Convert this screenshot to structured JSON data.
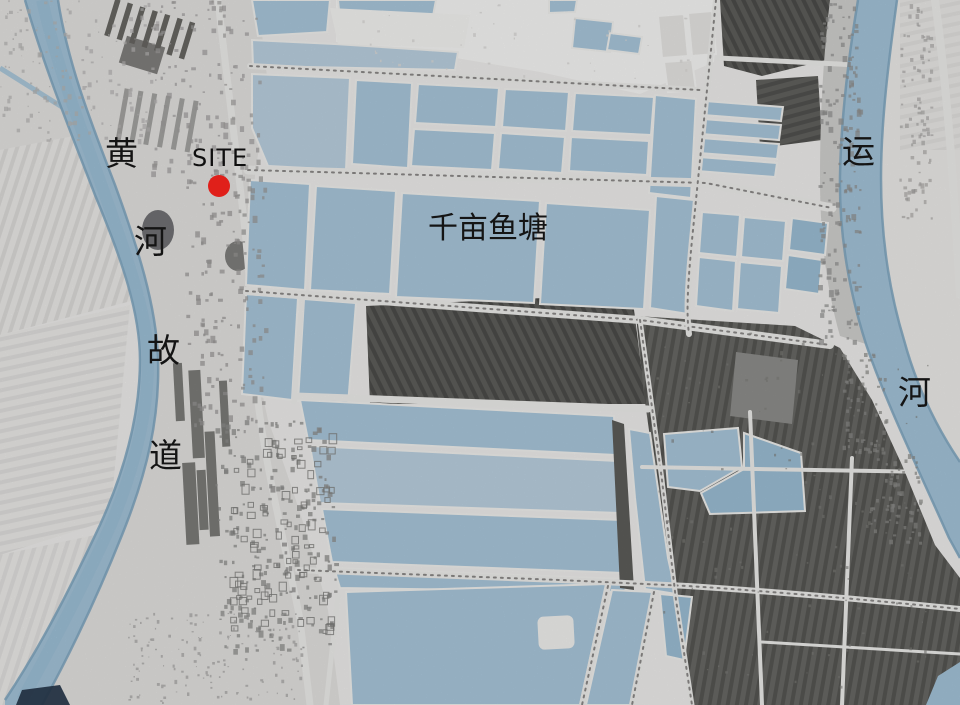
{
  "map": {
    "description": "site-location-aerial-map",
    "labels": {
      "site": "SITE",
      "fish_pond": "千亩鱼塘",
      "left_river": {
        "name": "黄河故道",
        "chars": [
          "黄",
          "河",
          "故",
          "道"
        ]
      },
      "right_river": {
        "name": "运河",
        "chars": [
          "运",
          "河"
        ]
      }
    },
    "marker": {
      "label": "SITE",
      "shape": "circle"
    },
    "colors": {
      "background": "#f2f1ef",
      "water": "#a6c6dc",
      "water_edge": "#7fa7c2",
      "pond": "#abc9de",
      "farmland_dark": "#696966",
      "site_marker": "#e0201a",
      "text": "#141414"
    }
  }
}
